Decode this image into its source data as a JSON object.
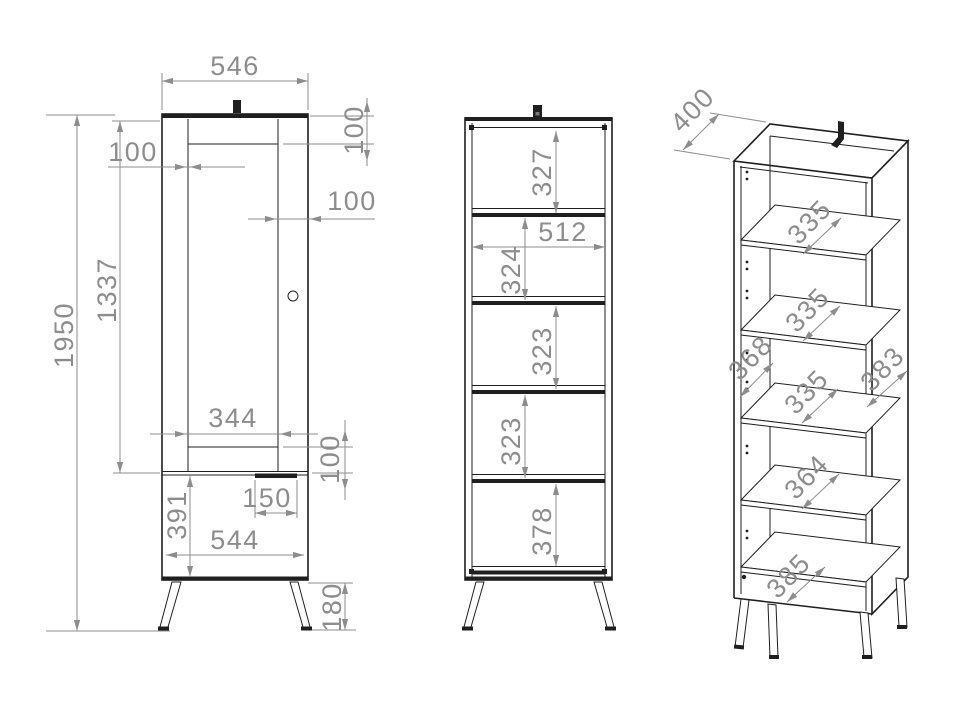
{
  "colors": {
    "edge": "#1f1f1f",
    "dim": "#8d8d8d",
    "bg": "#ffffff"
  },
  "drawing": {
    "type": "furniture technical drawing - tall cabinet, three views",
    "views": {
      "front_door": {
        "dims": {
          "top_width": "546",
          "top_rail": "100",
          "left_stile": "100",
          "right_stile": "100",
          "door_height": "1337",
          "total_height": "1950",
          "panel_width": "344",
          "bottom_rail": "100",
          "groove_width": "150",
          "base_height": "391",
          "base_width": "544",
          "leg_height": "180"
        }
      },
      "front_open": {
        "dims": {
          "top_space": "327",
          "inner_width": "512",
          "space_2": "324",
          "space_3": "323",
          "space_4": "323",
          "bottom_space": "378"
        }
      },
      "isometric": {
        "dims": {
          "depth": "400",
          "shelf_1": "335",
          "shelf_2": "335",
          "shelf_3": "335",
          "shelf_4": "364",
          "left_side_depth": "368",
          "right_side_depth": "383",
          "bottom_depth": "385"
        }
      }
    }
  }
}
